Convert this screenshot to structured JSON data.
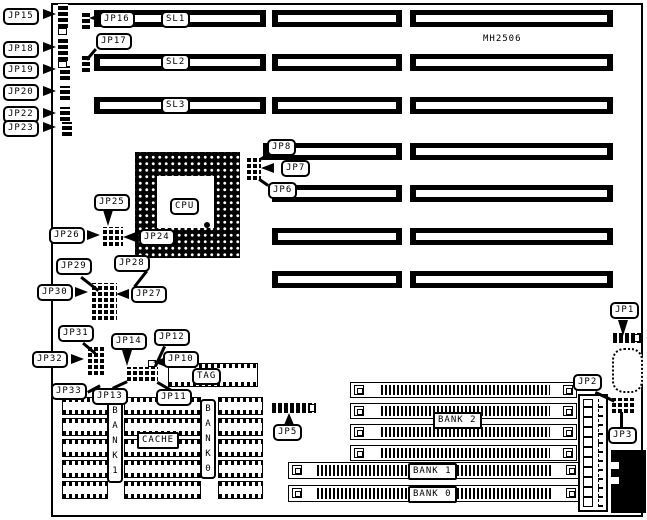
{
  "colors": {
    "foreground": "#000000",
    "background": "#ffffff"
  },
  "board": {
    "part_number": "MH2506"
  },
  "labels": {
    "jp1": "JP1",
    "jp2": "JP2",
    "jp3": "JP3",
    "jp5": "JP5",
    "jp6": "JP6",
    "jp7": "JP7",
    "jp8": "JP8",
    "jp10": "JP10",
    "jp11": "JP11",
    "jp12": "JP12",
    "jp13": "JP13",
    "jp14": "JP14",
    "jp15": "JP15",
    "jp16": "JP16",
    "jp17": "JP17",
    "jp18": "JP18",
    "jp19": "JP19",
    "jp20": "JP20",
    "jp22": "JP22",
    "jp23": "JP23",
    "jp24": "JP24",
    "jp25": "JP25",
    "jp26": "JP26",
    "jp27": "JP27",
    "jp28": "JP28",
    "jp29": "JP29",
    "jp30": "JP30",
    "jp31": "JP31",
    "jp32": "JP32",
    "jp33": "JP33"
  },
  "slots": {
    "sl1": "SL1",
    "sl2": "SL2",
    "sl3": "SL3"
  },
  "components": {
    "cpu": "CPU",
    "tag": "TAG",
    "cache": "CACHE"
  },
  "memory": {
    "bank2": "BANK 2",
    "bank1": "BANK 1",
    "bank0": "BANK 0",
    "bank1_vertical": "BANK1",
    "bank0_vertical": "BANK0"
  }
}
